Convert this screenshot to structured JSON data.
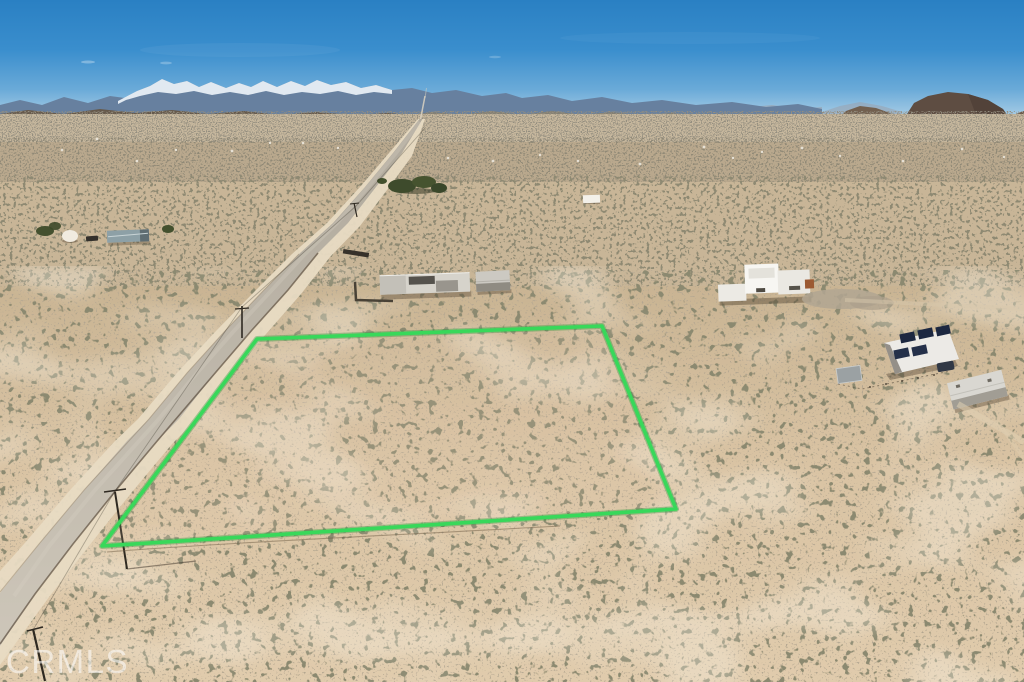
{
  "watermark": {
    "text": "CRMLS"
  },
  "parcel": {
    "outline_points": "257,339 602,326 676,509 102,546",
    "outline_color": "#38d85a",
    "outline_underlay_color": "#17912e"
  },
  "scene": {
    "sky_top_color": "#2a80c3",
    "sky_horizon_color": "#c6ddec",
    "sand_color": "#d9c3a4",
    "road_color": "#c3bcaf",
    "snow_color": "#ecf2f7"
  }
}
